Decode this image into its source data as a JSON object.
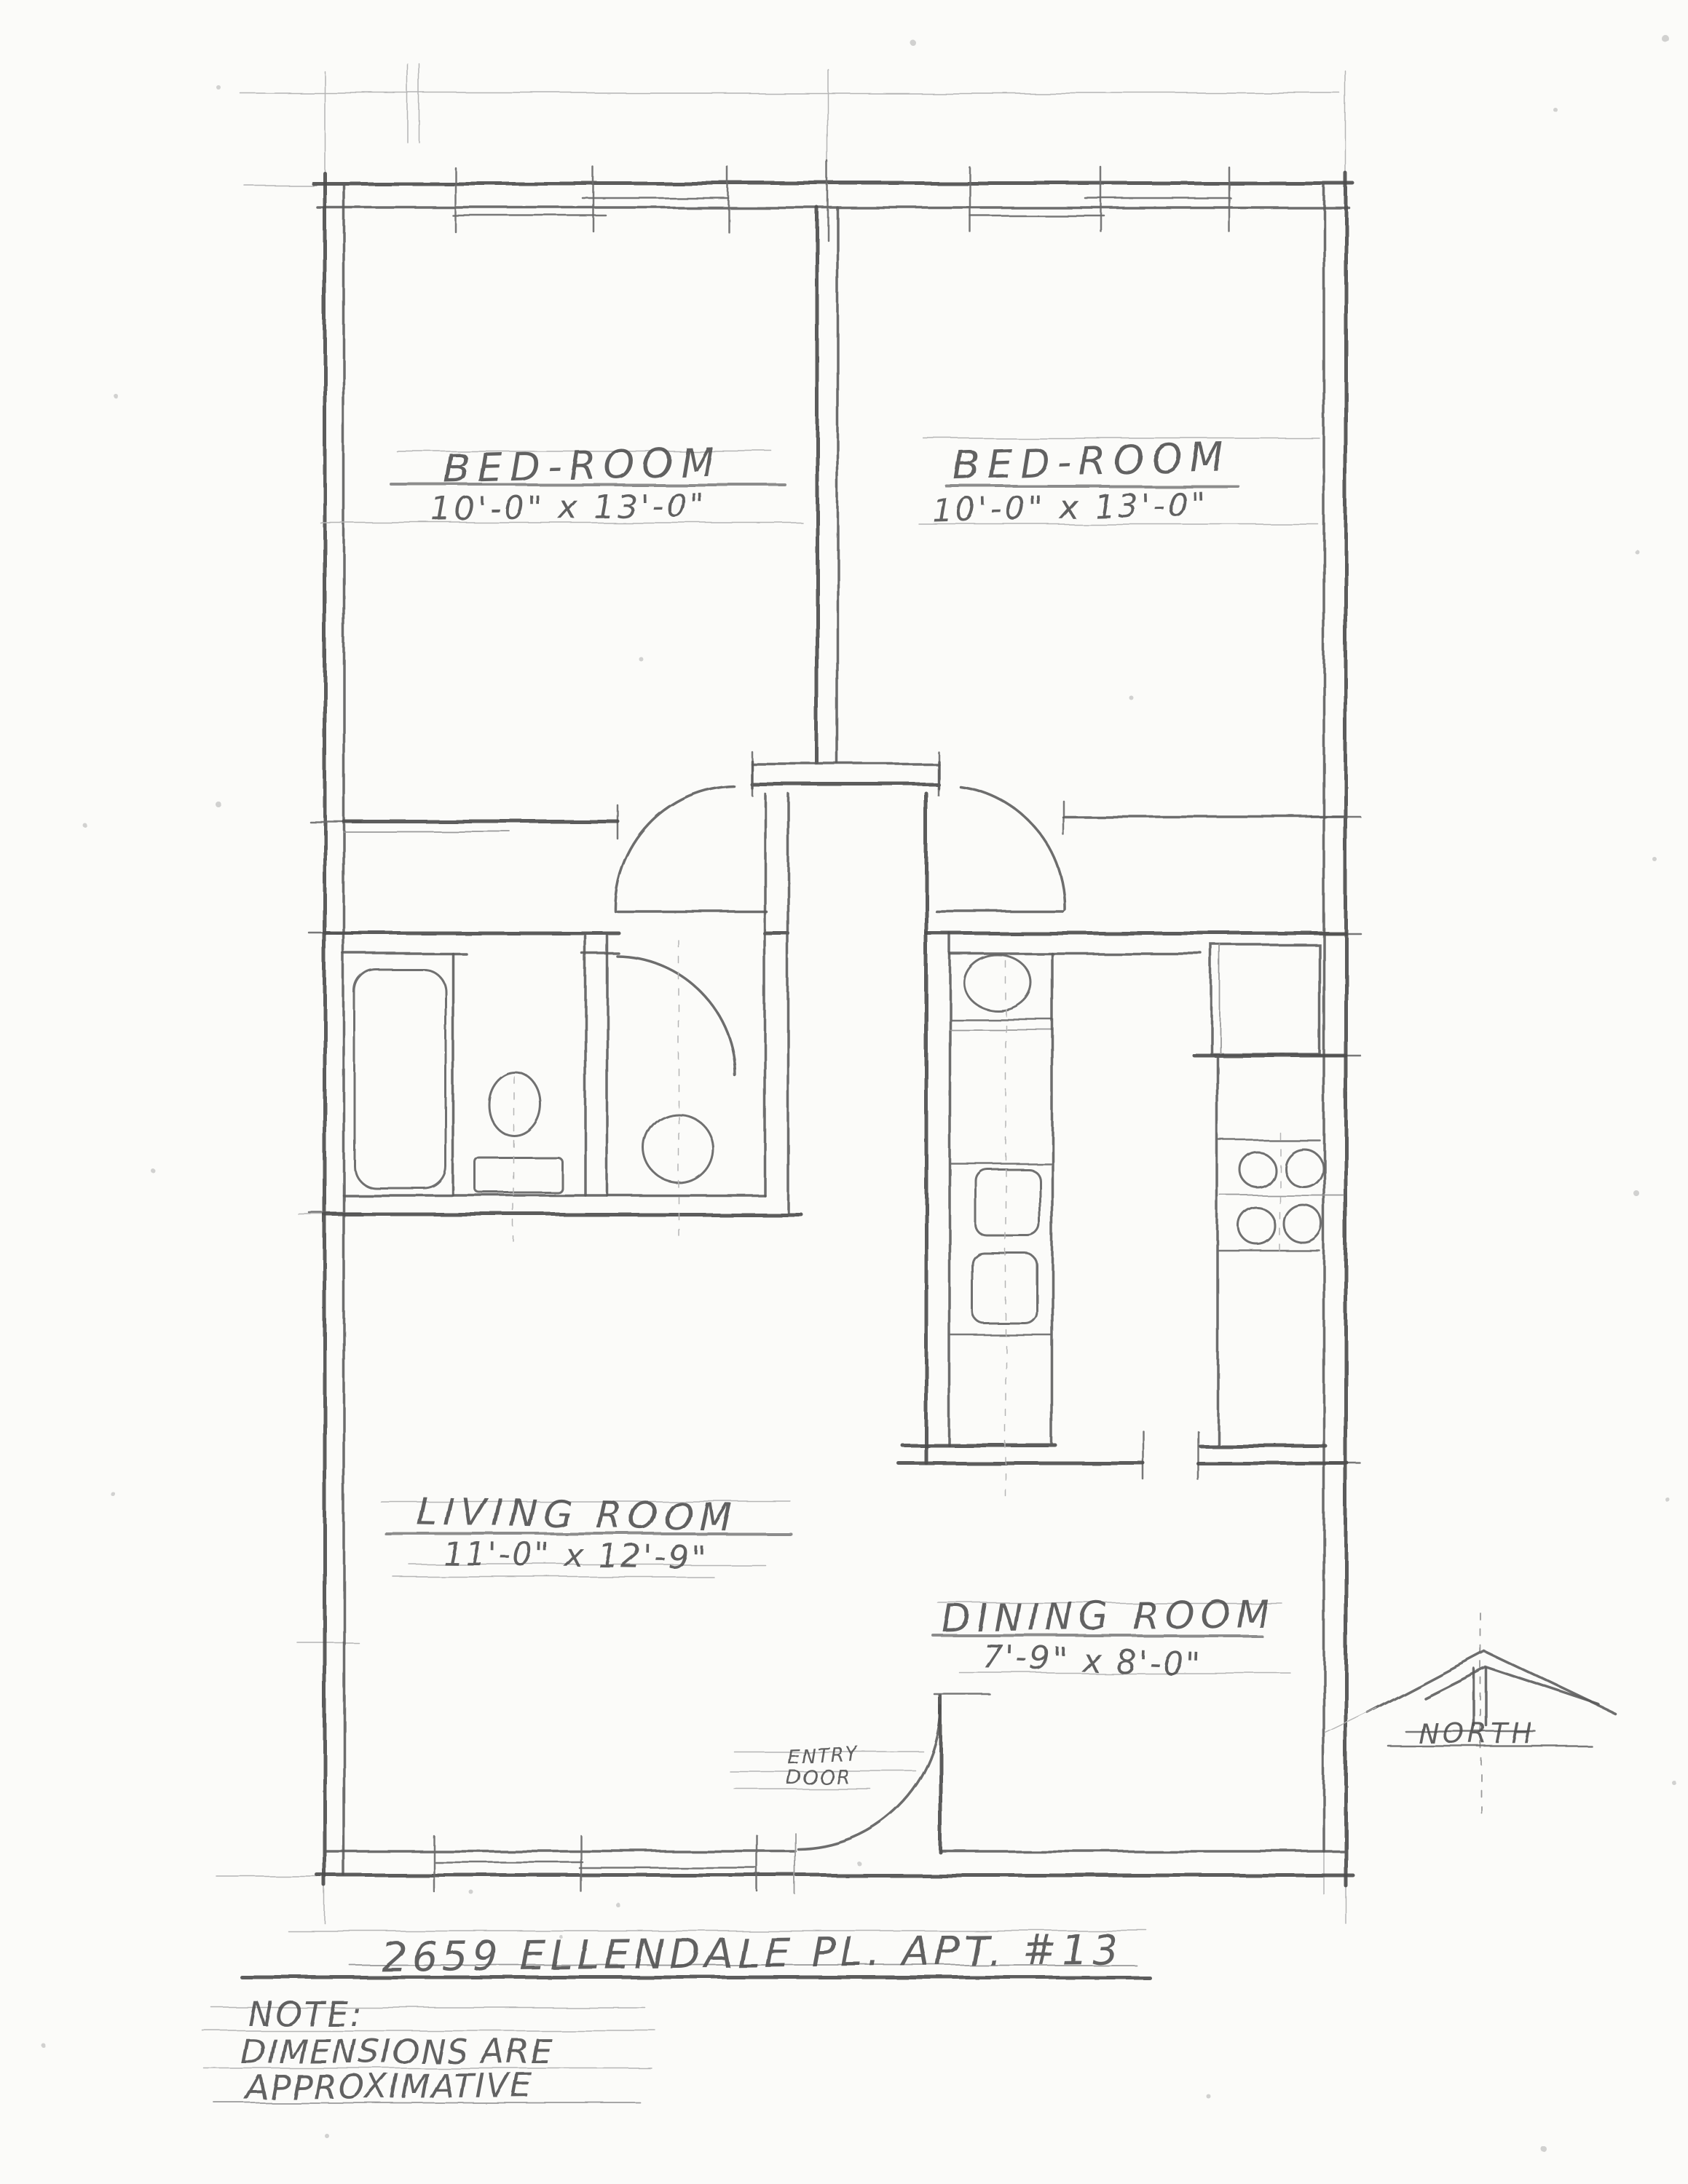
{
  "rooms": [
    {
      "id": "bedroom-left",
      "name": "BED-ROOM",
      "dims": "10'-0\" x 13'-0\""
    },
    {
      "id": "bedroom-right",
      "name": "BED-ROOM",
      "dims": "10'-0\" x 13'-0\""
    },
    {
      "id": "living-room",
      "name": "LIVING ROOM",
      "dims": "11'-0\" x 12'-9\""
    },
    {
      "id": "dining-room",
      "name": "DINING ROOM",
      "dims": "7'-9\" x 8'-0\""
    }
  ],
  "entry_door": {
    "line1": "ENTRY",
    "line2": "DOOR"
  },
  "compass": {
    "label": "NORTH"
  },
  "title": "2659 ELLENDALE PL.  APT. #13",
  "note": {
    "heading": "NOTE:",
    "line2": "DIMENSIONS ARE",
    "line3": "APPROXIMATIVE"
  },
  "colors": {
    "paper": "#fbfbf9",
    "pencil_dark": "#4e4e4e",
    "pencil": "#6a6a6a",
    "pencil_light": "#b5b5b5"
  }
}
